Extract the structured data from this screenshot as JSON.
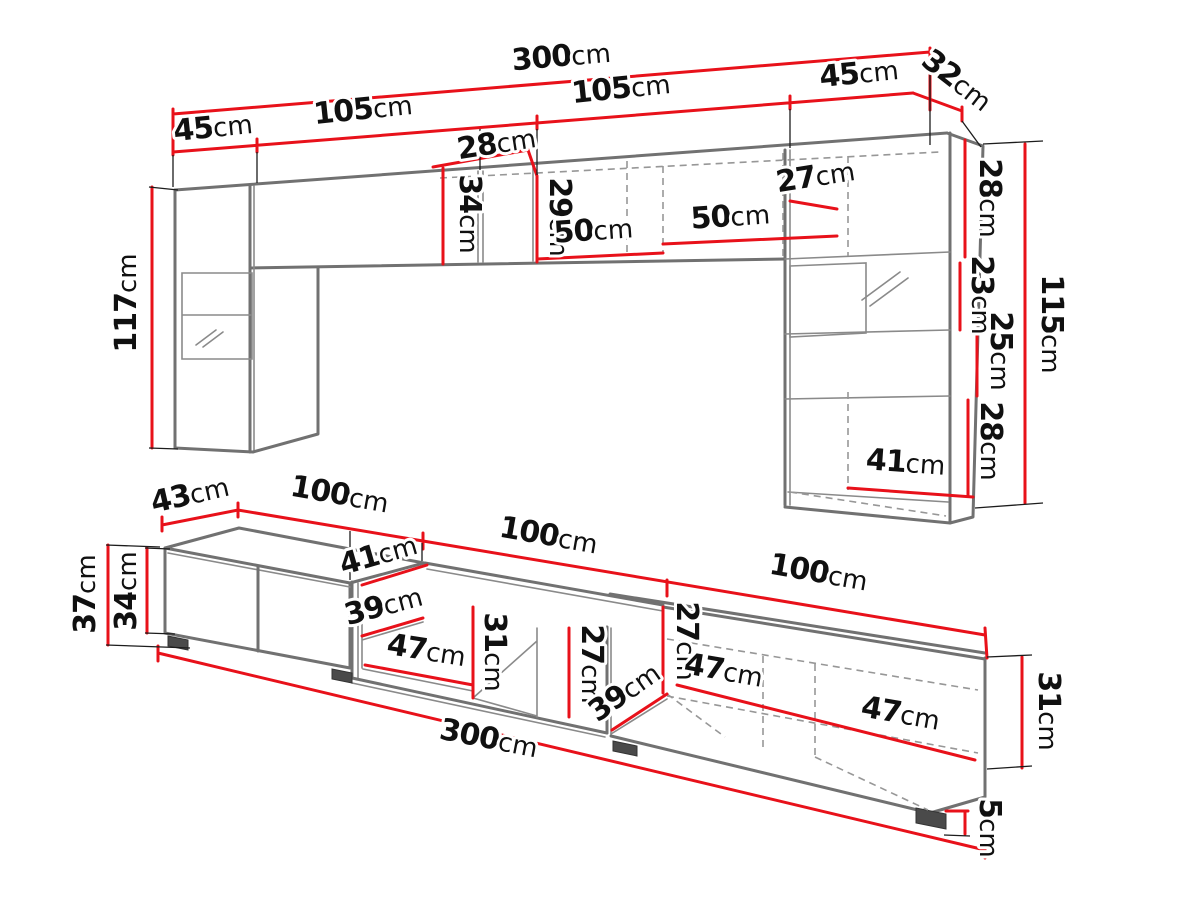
{
  "diagram": {
    "type": "furniture-dimension-drawing",
    "subject": "wall-unit-and-tv-stand-set",
    "unit": "cm",
    "colors": {
      "dimension_accent": "#e8111a",
      "furniture_line": "#717171",
      "hidden_edge": "#979797",
      "text": "#101010",
      "background": "#ffffff"
    },
    "upper_view": {
      "name": "wall-cabinets-front-view",
      "overall_width_cm": 300,
      "labels": [
        {
          "v": "300",
          "u": "cm",
          "x": 562,
          "y": 66,
          "r": -5
        },
        {
          "v": "45",
          "u": "cm",
          "x": 214,
          "y": 137,
          "r": -6
        },
        {
          "v": "105",
          "u": "cm",
          "x": 364,
          "y": 119,
          "r": -6
        },
        {
          "v": "105",
          "u": "cm",
          "x": 622,
          "y": 98,
          "r": -6
        },
        {
          "v": "45",
          "u": "cm",
          "x": 860,
          "y": 83,
          "r": -6
        },
        {
          "v": "32",
          "u": "cm",
          "x": 951,
          "y": 88,
          "r": 38
        },
        {
          "v": "28",
          "u": "cm",
          "x": 498,
          "y": 153,
          "r": -9
        },
        {
          "v": "34",
          "u": "cm",
          "x": 460,
          "y": 214,
          "r": 90
        },
        {
          "v": "29",
          "u": "cm",
          "x": 550,
          "y": 217,
          "r": 90
        },
        {
          "v": "50",
          "u": "cm",
          "x": 594,
          "y": 240,
          "r": -4
        },
        {
          "v": "50",
          "u": "cm",
          "x": 731,
          "y": 226,
          "r": -4
        },
        {
          "v": "27",
          "u": "cm",
          "x": 817,
          "y": 186,
          "r": -9
        },
        {
          "v": "28",
          "u": "cm",
          "x": 980,
          "y": 198,
          "r": 90
        },
        {
          "v": "23",
          "u": "cm",
          "x": 972,
          "y": 295,
          "r": 90
        },
        {
          "v": "25",
          "u": "cm",
          "x": 991,
          "y": 351,
          "r": 90
        },
        {
          "v": "28",
          "u": "cm",
          "x": 981,
          "y": 441,
          "r": 90
        },
        {
          "v": "115",
          "u": "cm",
          "x": 1042,
          "y": 324,
          "r": 90
        },
        {
          "v": "41",
          "u": "cm",
          "x": 905,
          "y": 472,
          "r": 4
        },
        {
          "v": "117",
          "u": "cm",
          "x": 136,
          "y": 303,
          "r": -90
        }
      ]
    },
    "lower_view": {
      "name": "tv-stands-perspective-view",
      "overall_width_cm": 300,
      "labels": [
        {
          "v": "43",
          "u": "cm",
          "x": 192,
          "y": 504,
          "r": -13
        },
        {
          "v": "100",
          "u": "cm",
          "x": 338,
          "y": 504,
          "r": 10
        },
        {
          "v": "100",
          "u": "cm",
          "x": 547,
          "y": 545,
          "r": 10
        },
        {
          "v": "100",
          "u": "cm",
          "x": 817,
          "y": 582,
          "r": 10
        },
        {
          "v": "41",
          "u": "cm",
          "x": 381,
          "y": 564,
          "r": -16
        },
        {
          "v": "39",
          "u": "cm",
          "x": 386,
          "y": 615,
          "r": -15
        },
        {
          "v": "47",
          "u": "cm",
          "x": 425,
          "y": 660,
          "r": 9
        },
        {
          "v": "31",
          "u": "cm",
          "x": 485,
          "y": 652,
          "r": 90
        },
        {
          "v": "27",
          "u": "cm",
          "x": 582,
          "y": 664,
          "r": 90
        },
        {
          "v": "39",
          "u": "cm",
          "x": 630,
          "y": 700,
          "r": -35
        },
        {
          "v": "27",
          "u": "cm",
          "x": 677,
          "y": 641,
          "r": 90
        },
        {
          "v": "47",
          "u": "cm",
          "x": 722,
          "y": 680,
          "r": 10
        },
        {
          "v": "47",
          "u": "cm",
          "x": 899,
          "y": 723,
          "r": 10
        },
        {
          "v": "31",
          "u": "cm",
          "x": 1039,
          "y": 711,
          "r": 90
        },
        {
          "v": "5",
          "u": "cm",
          "x": 980,
          "y": 828,
          "r": 90
        },
        {
          "v": "300",
          "u": "cm",
          "x": 487,
          "y": 748,
          "r": 11
        },
        {
          "v": "37",
          "u": "cm",
          "x": 95,
          "y": 594,
          "r": -90
        },
        {
          "v": "34",
          "u": "cm",
          "x": 136,
          "y": 591,
          "r": -90
        }
      ]
    }
  }
}
